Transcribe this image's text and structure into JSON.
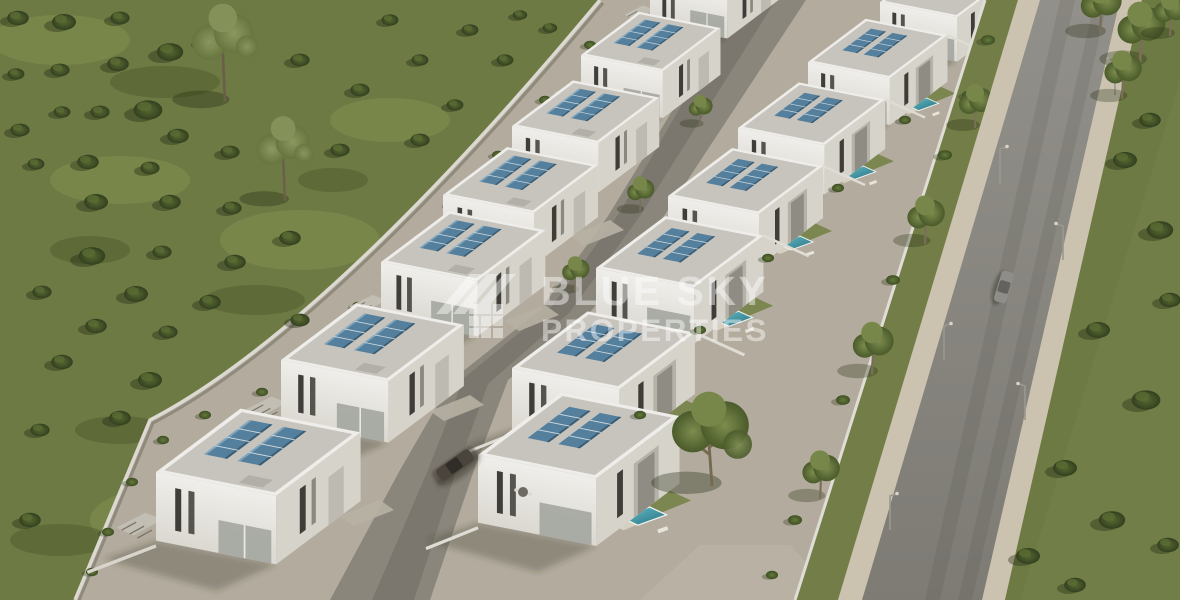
{
  "watermark": {
    "line1": "BLUE SKY",
    "line2": "PROPERTIES",
    "color": "#ffffff",
    "opacity": "0.45",
    "logo": "roof-stripes-and-window-grid"
  },
  "scene": {
    "setting": "aerial-3d-render-of-modern-villa-development",
    "left_row_villa_count": 7,
    "right_row_villa_count": 7,
    "features": [
      "flat-roof-white-villas",
      "rooftop-solar-panels",
      "private-pools",
      "internal-street",
      "main-road",
      "sidewalks",
      "street-lamps",
      "green-field",
      "scattered-bushes",
      "trees",
      "boundary-walls"
    ],
    "vehicles": [
      {
        "name": "car-on-internal-street",
        "color": "#4a443c"
      },
      {
        "name": "car-on-main-road",
        "color": "#8f8d8a"
      }
    ]
  },
  "palette": {
    "grass": "#6e7a44",
    "grass_light": "#839050",
    "grass_dark": "#4c5729",
    "bush": "#3f4d26",
    "ground": "#b3ac9e",
    "street": "#8a867c",
    "road": "#8b8983",
    "sidewalk": "#cbc3b0",
    "roof": "#c7c4be",
    "wall_light": "#edece8",
    "wall_shade": "#d4d1c9",
    "solar": "#54809e",
    "pool": "#3a8697",
    "wall_line": "#dcd9d2"
  }
}
